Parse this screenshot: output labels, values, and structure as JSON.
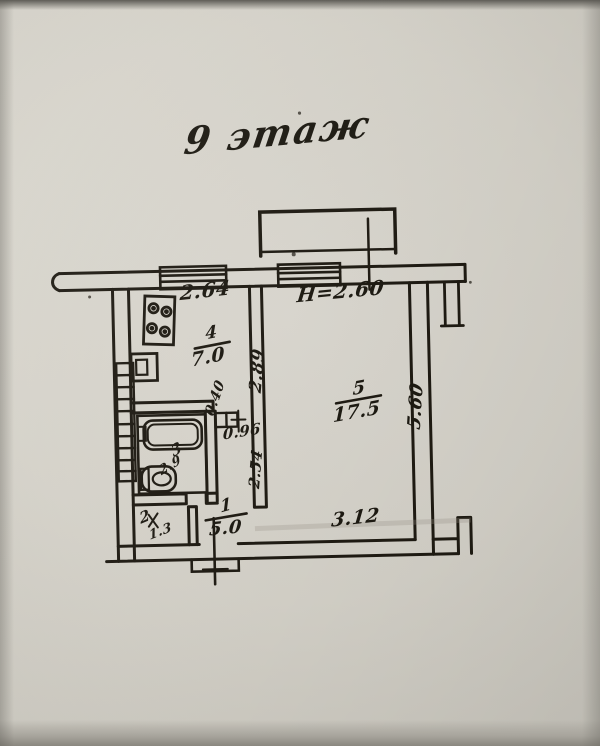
{
  "title": "9 этаж",
  "rooms": {
    "hall": {
      "number": "1",
      "area": "5.0"
    },
    "closet": {
      "number": "2",
      "area": "1.3"
    },
    "bath": {
      "number": "3",
      "area": "2.9"
    },
    "kitchen": {
      "number": "4",
      "area": "7.0"
    },
    "living": {
      "number": "5",
      "area": "17.5"
    }
  },
  "dims": {
    "kitchen_width": "2.64",
    "kitchen_depth": "2.89",
    "vent_niche": "0.40",
    "corridor_width": "0.96",
    "corridor_length": "2.54",
    "living_width": "3.12",
    "living_depth": "5.60",
    "ceiling_height": "Н=2.60"
  },
  "colors": {
    "ink": "#1f1b13",
    "paper": "#d8d5cc"
  },
  "fixtures": [
    "stove-icon",
    "sink-icon",
    "bathtub-icon",
    "toilet-icon",
    "vent-shaft-icon",
    "balcony",
    "window",
    "entrance-door"
  ]
}
